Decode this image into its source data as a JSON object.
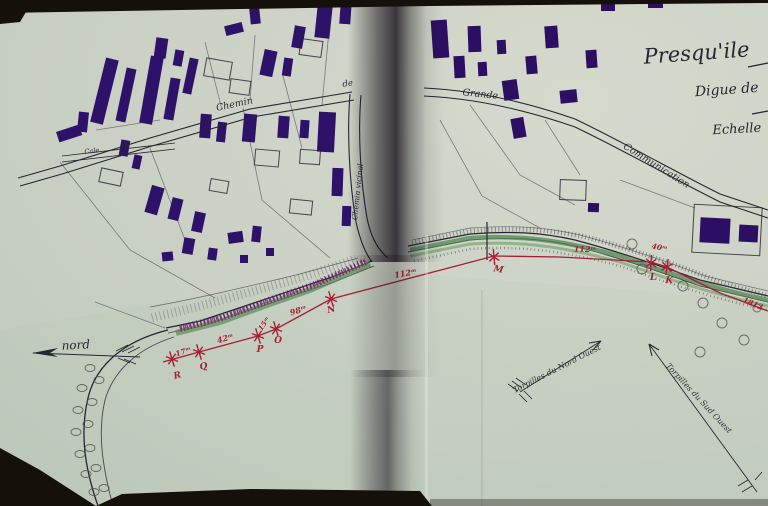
{
  "title_block": {
    "title": "Presqu'ile",
    "line2": "Digue de",
    "line3": "Echelle"
  },
  "compass": {
    "label": "nord"
  },
  "roads": {
    "chemin": "Chemin",
    "de": "de",
    "grande": "Grande",
    "communication": "Communication",
    "vicinal": "Chemin vicinal",
    "cale": "Cale"
  },
  "annotations": {
    "nw_arrow": "Torpilles du Nord Ouest",
    "sw_arrow": "Torpilles du Sud Ouest"
  },
  "survey": {
    "stations": [
      "R",
      "Q",
      "P",
      "O",
      "N",
      "M",
      "L",
      "K"
    ],
    "measurements": [
      "17ᵐ",
      "42ᵐ",
      "15ᵐ",
      "98ᵐ",
      "112ᵐ",
      "112ᵐ",
      "40ᵐ",
      "1813"
    ],
    "color": "#a61f33"
  },
  "palette": {
    "paper": "#cbd1c5",
    "ink": "#262531",
    "building": "#2e1168",
    "green_band": "#4f8751",
    "revetment": "#8d2366",
    "survey_red": "#a61f33",
    "photo_background": "#17110b"
  }
}
